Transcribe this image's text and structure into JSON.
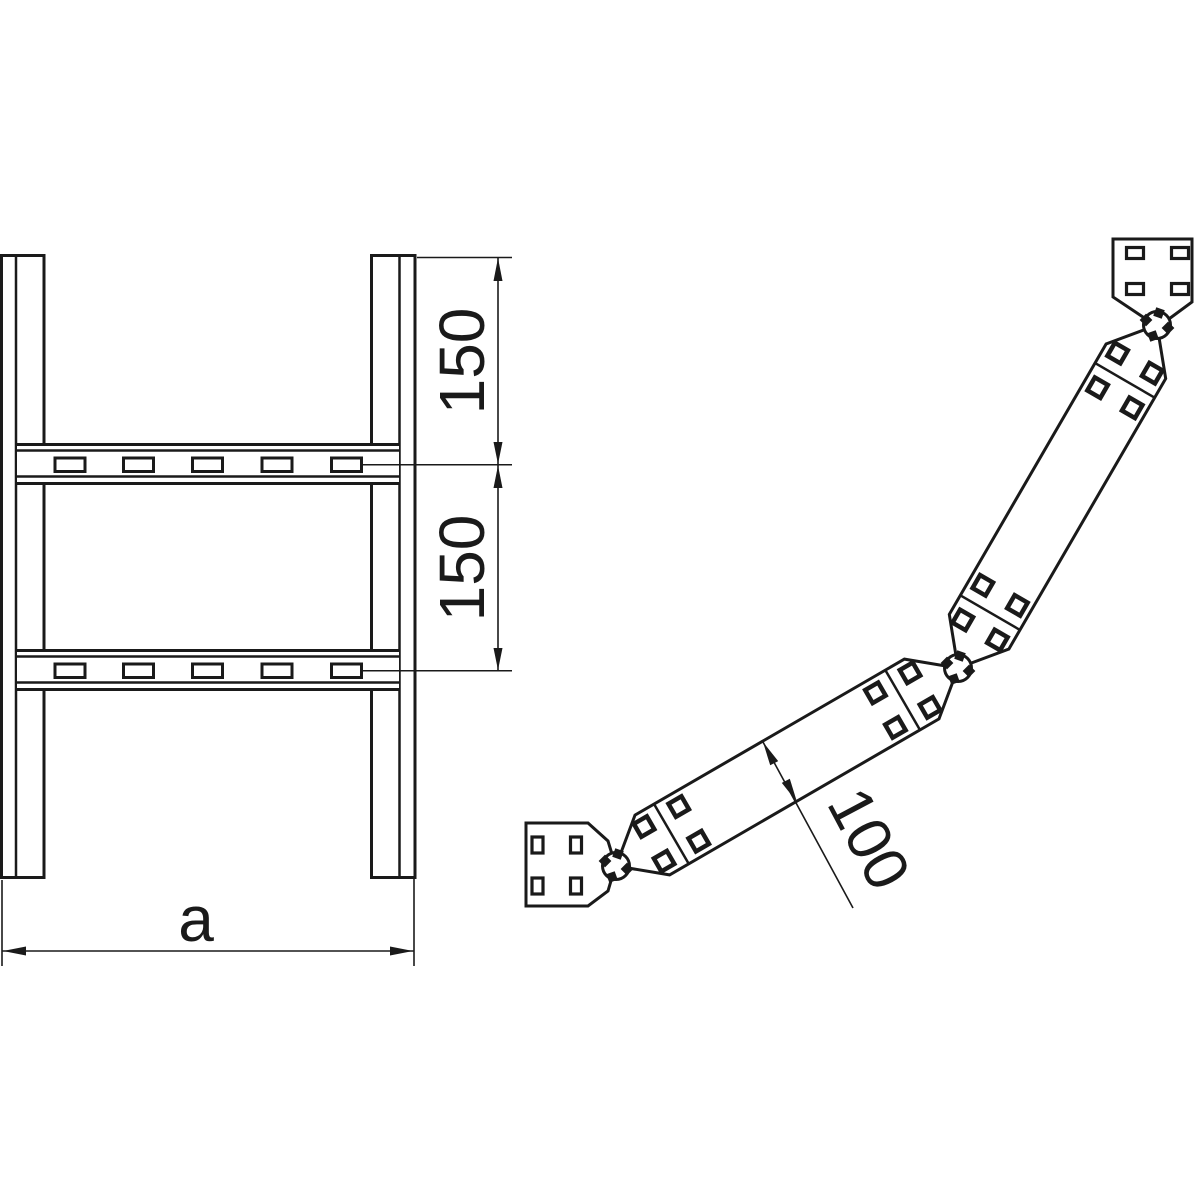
{
  "drawing": {
    "front_view": {
      "dim_upper_spacing": "150",
      "dim_lower_spacing": "150",
      "dim_width": "a"
    },
    "side_view": {
      "dim_depth": "100"
    }
  },
  "colors": {
    "line": "#1a1a1a",
    "background": "#ffffff"
  }
}
